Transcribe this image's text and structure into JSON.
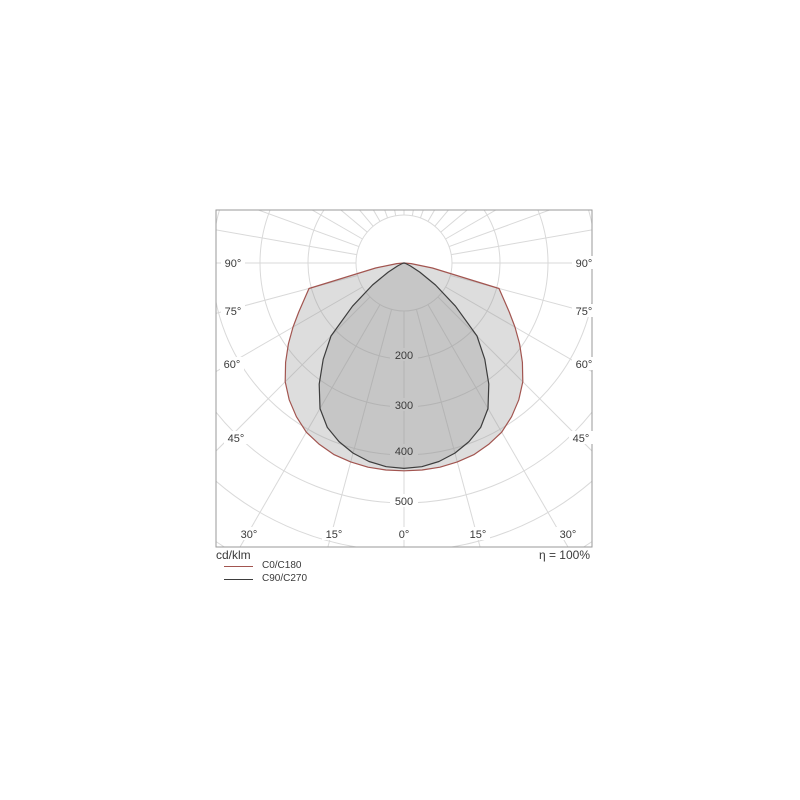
{
  "diagram": {
    "unit_label": "cd/klm",
    "efficiency_label": "η = 100%",
    "angle_labels": {
      "left": [
        "90°",
        "75°",
        "60°",
        "45°",
        "30°"
      ],
      "bottom": [
        "15°",
        "0°",
        "15°"
      ],
      "right": [
        "90°",
        "75°",
        "60°",
        "45°",
        "30°"
      ]
    },
    "radial_tick_labels": [
      "200",
      "300",
      "400",
      "500"
    ],
    "legend": [
      {
        "label": "C0/C180",
        "color": "#a25550"
      },
      {
        "label": "C90/C270",
        "color": "#3d3d3d"
      }
    ],
    "colors": {
      "grid": "#d9d9d9",
      "frame": "#9a9a9a",
      "text": "#3a3a3a",
      "region_fill": "rgba(150,150,150,0.32)",
      "inner_label_bg": "#c6c6c6",
      "outer_label_bg": "#ffffff",
      "background": "#ffffff"
    }
  },
  "chart_data": {
    "type": "polar-photometric-intensity",
    "title": "Luminous intensity distribution curve",
    "unit": "cd/klm",
    "efficiency_percent": 100,
    "gamma_deg": [
      0,
      5,
      10,
      15,
      20,
      25,
      30,
      35,
      40,
      45,
      50,
      55,
      60,
      65,
      70,
      75,
      80,
      85,
      90
    ],
    "series": [
      {
        "name": "C0/C180",
        "color": "#a25550",
        "values": [
          433,
          433,
          432,
          429,
          425,
          417,
          407,
          391,
          372,
          350,
          322,
          294,
          267,
          242,
          221,
          205,
          60,
          15,
          0
        ]
      },
      {
        "name": "C90/C270",
        "color": "#3d3d3d",
        "values": [
          428,
          426,
          420,
          410,
          396,
          378,
          350,
          308,
          262,
          215,
          140,
          80,
          38,
          15,
          6,
          2,
          0,
          0,
          0
        ]
      }
    ],
    "radial_grid_values": [
      100,
      200,
      300,
      400,
      500,
      600,
      700
    ],
    "labeled_radial_values": [
      200,
      300,
      400,
      500
    ],
    "angle_grid_step_deg": 15,
    "angle_labels_deg": [
      90,
      75,
      60,
      45,
      30,
      15,
      0
    ],
    "symmetric": true,
    "legend_position": "bottom-left"
  }
}
